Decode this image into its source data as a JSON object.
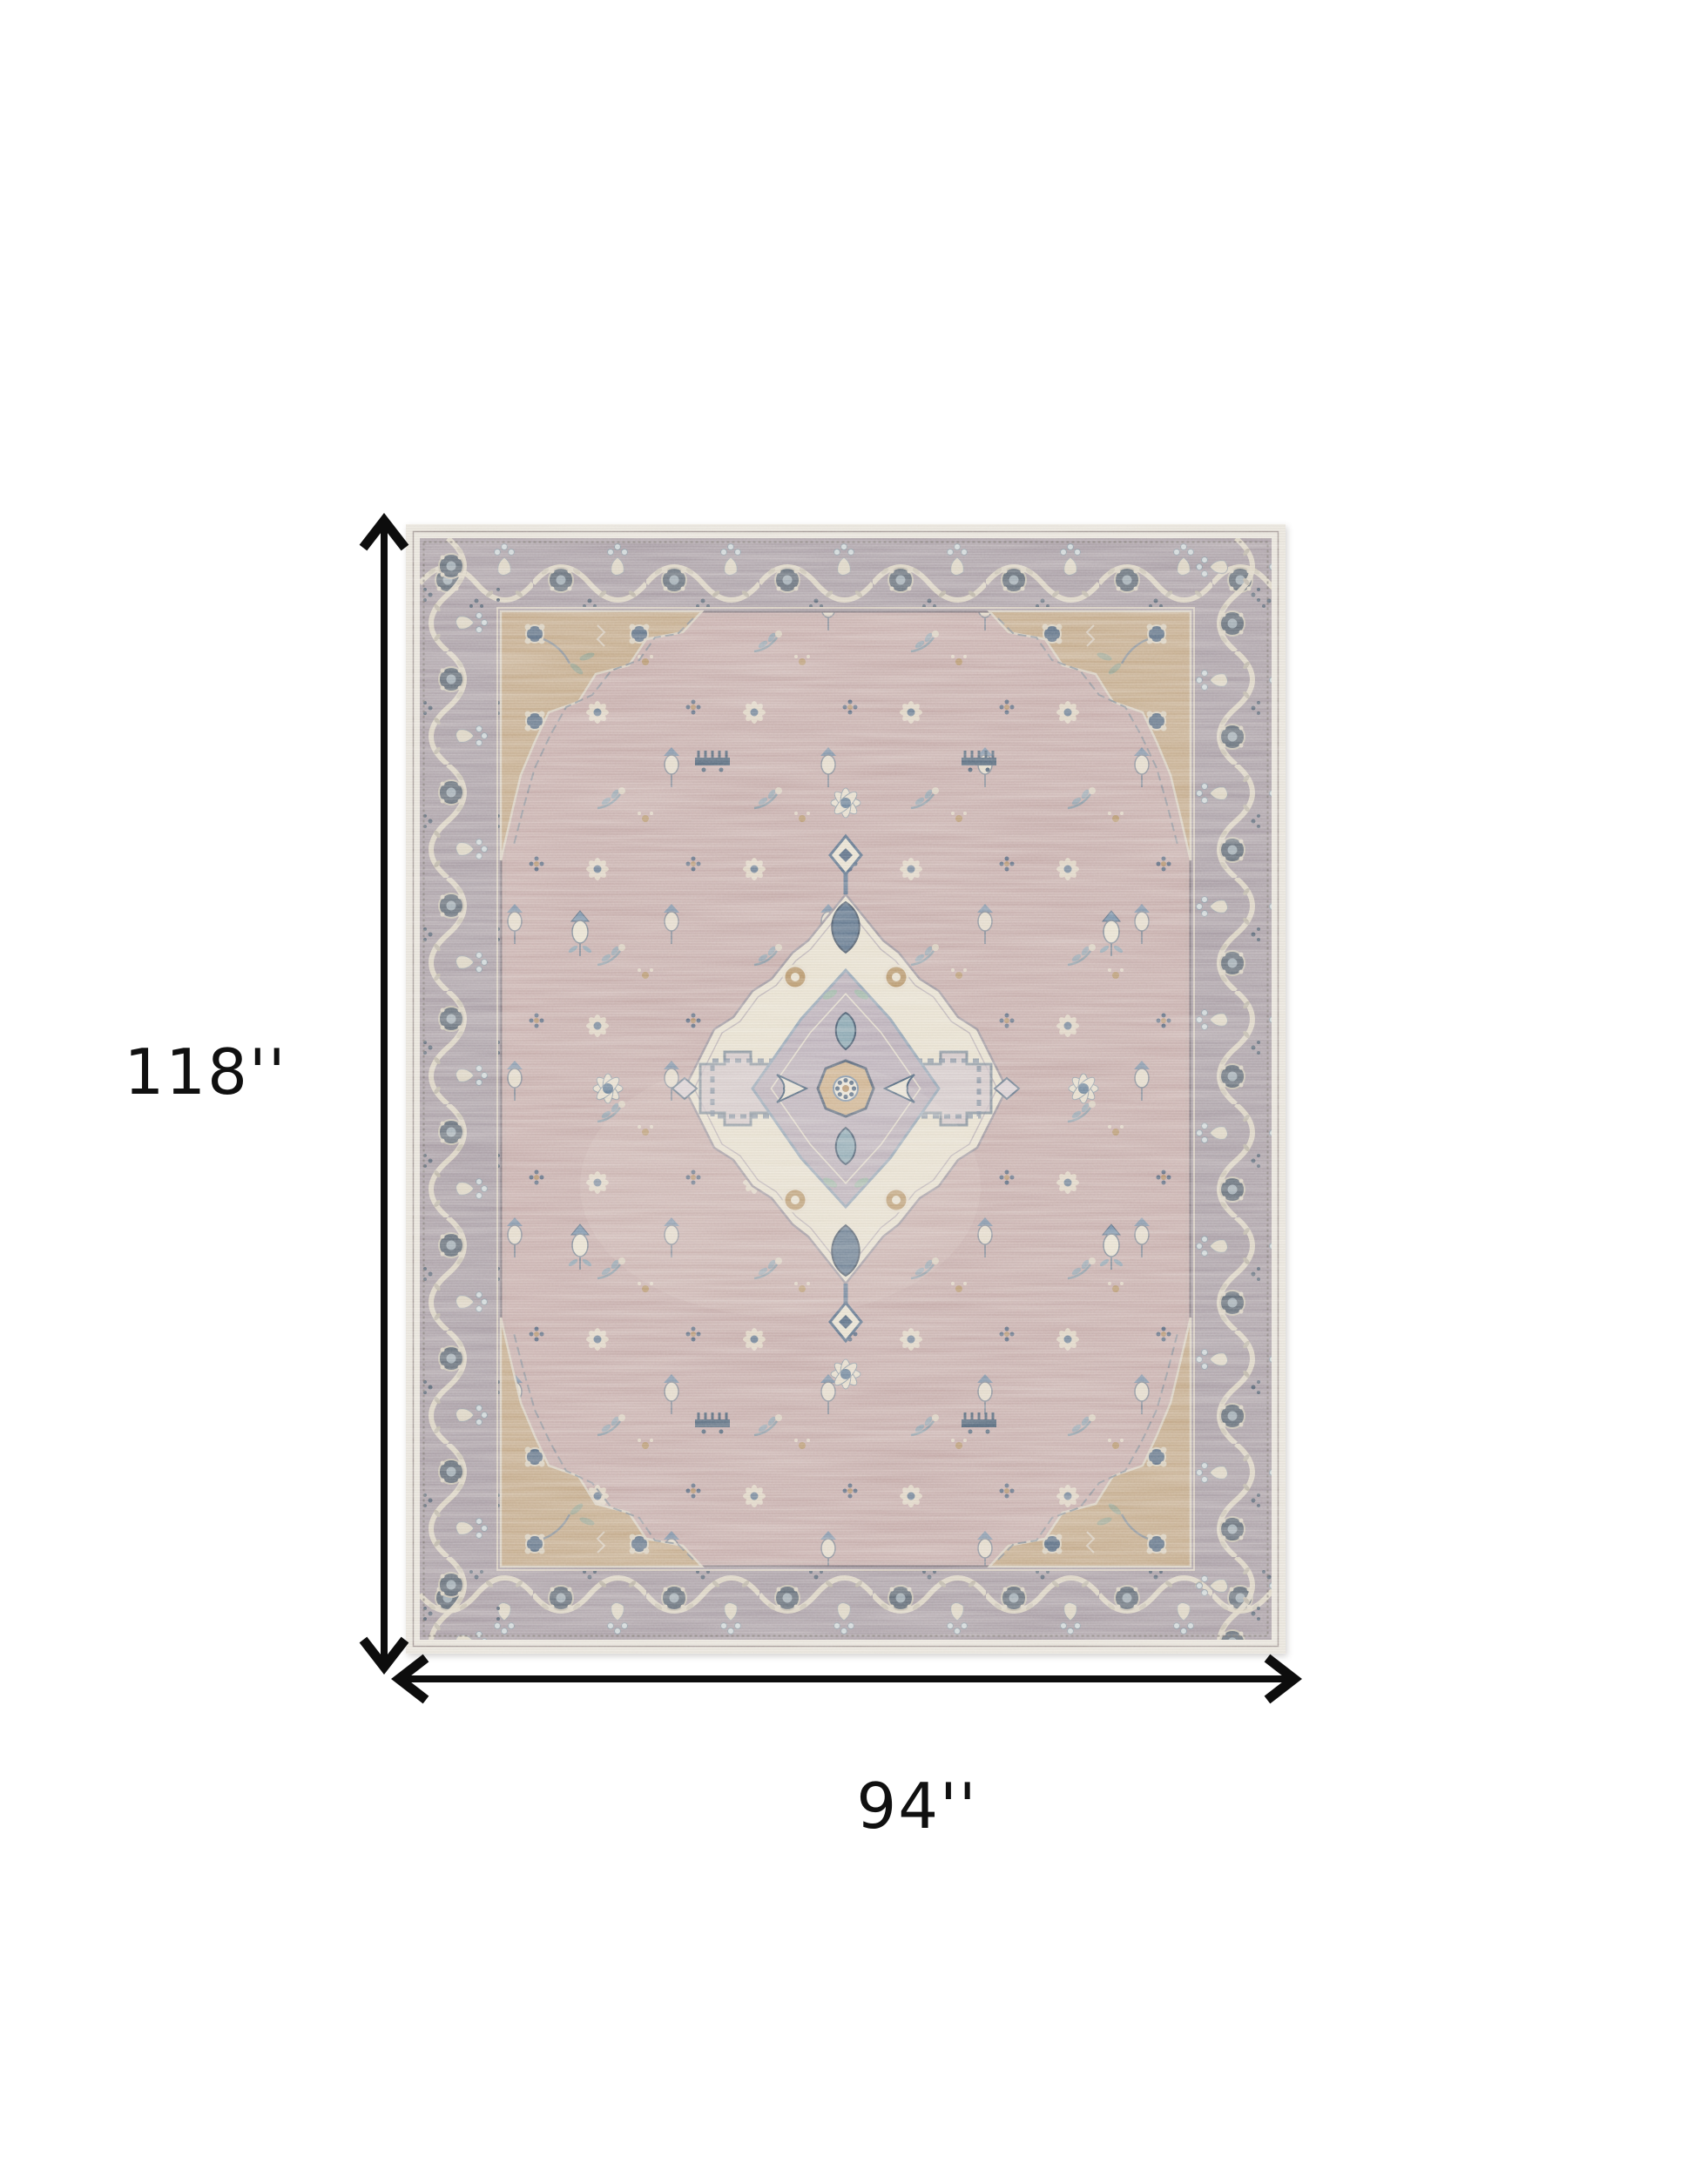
{
  "page": {
    "background": "#ffffff"
  },
  "annotations": {
    "height_label": "118''",
    "width_label": "94''",
    "arrow_color": "#0d0d0d"
  },
  "rug": {
    "semantic": "vintage-persian-style-medallion-area-rug",
    "palette": {
      "outer_edge": "#e9e5dc",
      "border_band": "#a59aa2",
      "field": "#c5aaa8",
      "spandrel": "#c2a785",
      "medallion_cream": "#e8e1cf",
      "inner_diamond": "#b6aab5",
      "steel_blue": "#5d7892",
      "navy": "#3f5875",
      "tan": "#b08a5e",
      "sage": "#93a08b"
    }
  }
}
